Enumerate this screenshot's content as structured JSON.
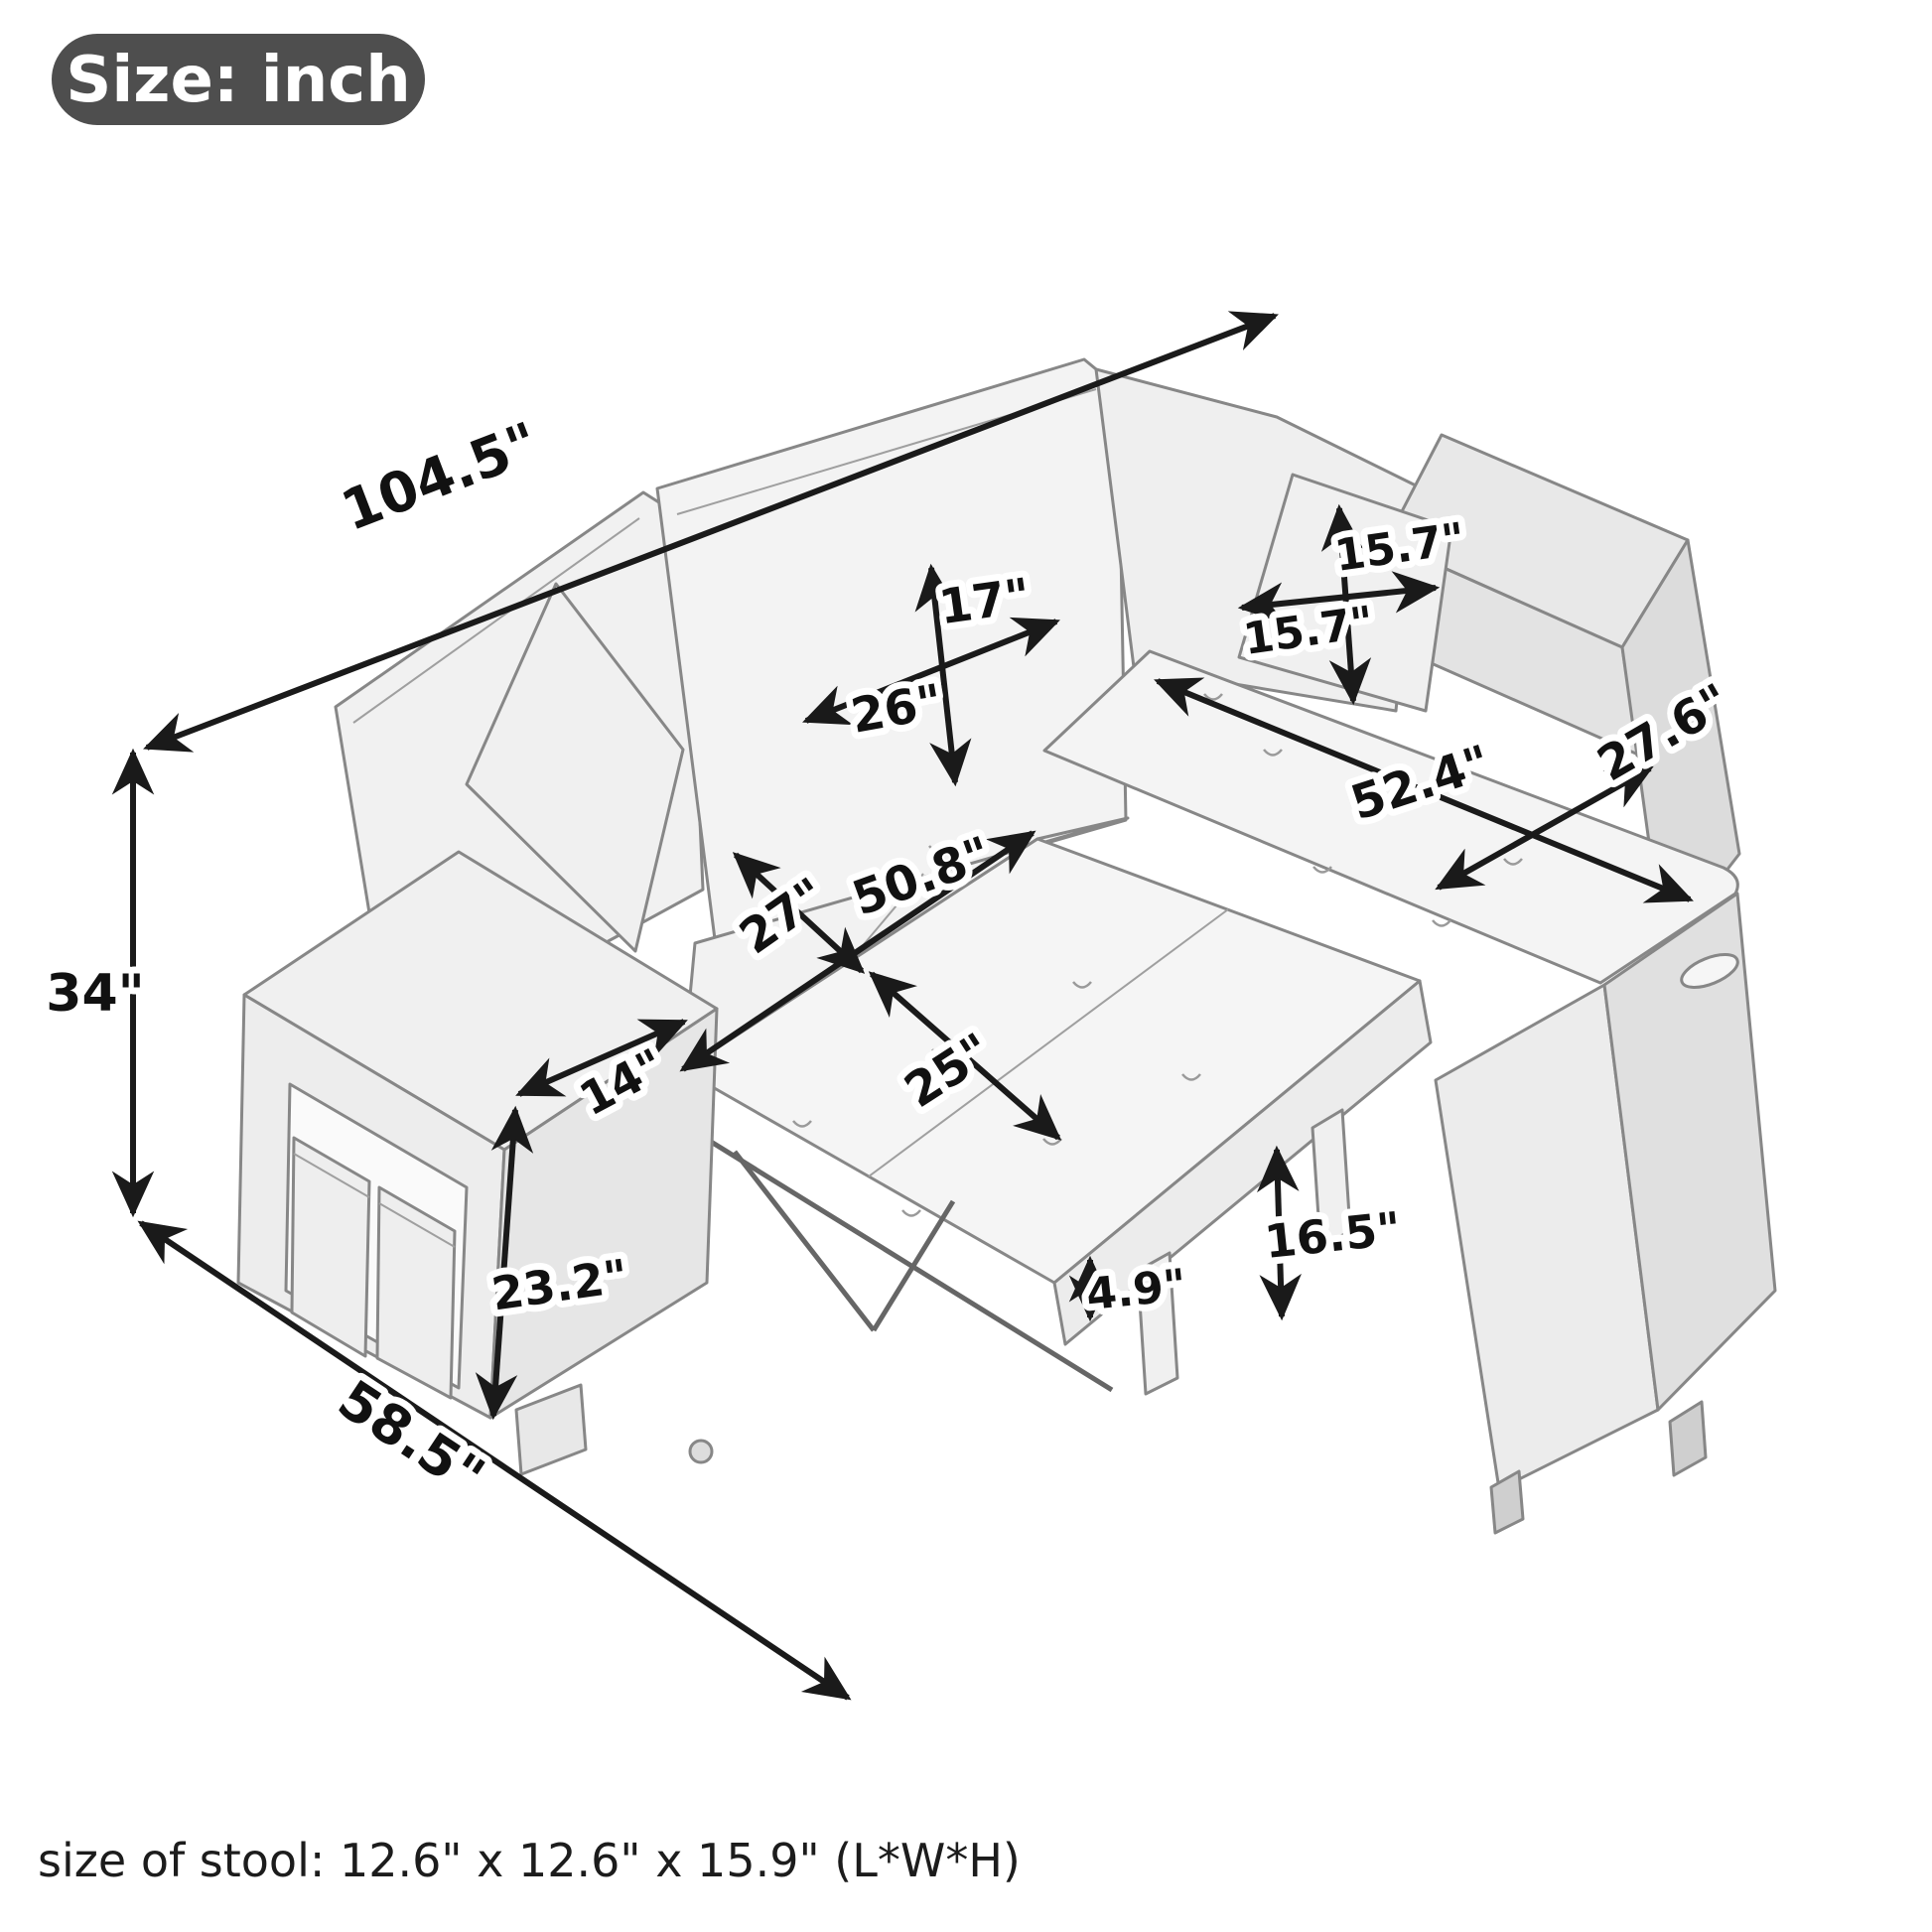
{
  "badge": {
    "label": "Size: inch"
  },
  "caption": {
    "stool_size_note": "size of stool: 12.6\" x 12.6\" x 15.9\" (L*W*H)"
  },
  "diagram": {
    "type": "product-dimension-diagram",
    "subject": "L-shaped sectional sleeper sofa with pull-out bed, storage chaise, two pillows and two stools under armrest",
    "unit": "inch",
    "line_color": "#1a1a1a",
    "badge_color": "#4e4e4e",
    "dimensions": {
      "overall_length": "104.5\"",
      "overall_height": "34\"",
      "overall_depth": "58.5\"",
      "back_cushion_height": "17\"",
      "back_cushion_width": "26\"",
      "pillow_height": "15.7\"",
      "pillow_width": "15.7\"",
      "chaise_seat_length": "52.4\"",
      "chaise_seat_width": "27.6\"",
      "pullout_bed_length": "50.8\"",
      "seat_depth": "27\"",
      "pullout_bed_depth": "25\"",
      "armrest_width": "14\"",
      "armrest_height": "23.2\"",
      "pullout_bed_height": "16.5\"",
      "mattress_thickness": "4.9\""
    }
  }
}
